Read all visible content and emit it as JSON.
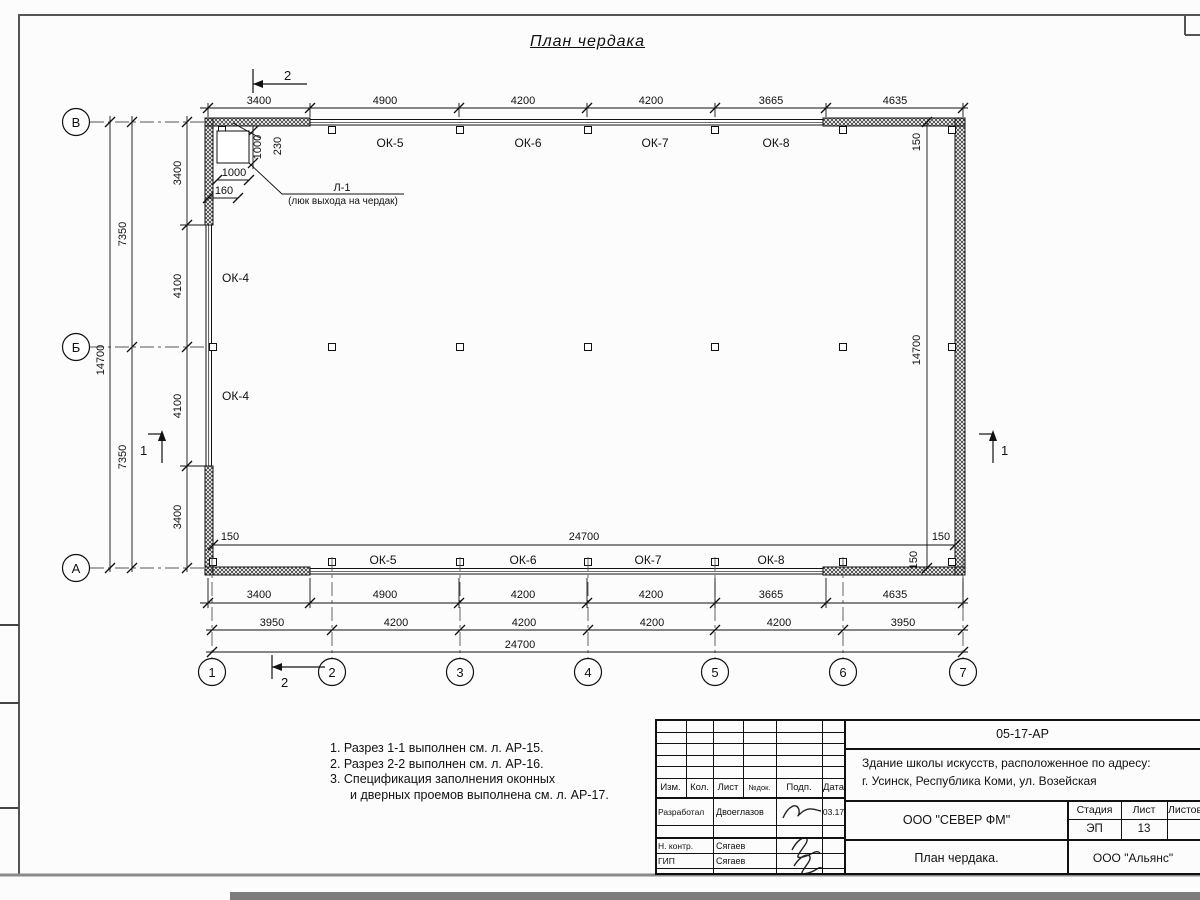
{
  "sheet": {
    "title": "План чердака"
  },
  "plan": {
    "axes_rows": [
      "В",
      "Б",
      "А"
    ],
    "axes_cols": [
      "1",
      "2",
      "3",
      "4",
      "5",
      "6",
      "7"
    ],
    "dims_top": [
      "3400",
      "4900",
      "4200",
      "4200",
      "3665",
      "4635"
    ],
    "dims_row1": [
      "3400",
      "4900",
      "4200",
      "4200",
      "3665",
      "4635"
    ],
    "dims_row2": [
      "3950",
      "4200",
      "4200",
      "4200",
      "4200",
      "3950"
    ],
    "total_width": "24700",
    "total_height": "14700",
    "left_inner": [
      "3400",
      "4100",
      "4100",
      "3400"
    ],
    "left_mid": [
      "7350",
      "7350"
    ],
    "d150": "150",
    "windows_top": [
      "ОК-5",
      "ОК-6",
      "ОК-7",
      "ОК-8"
    ],
    "windows_bottom": [
      "ОК-5",
      "ОК-6",
      "ОК-7",
      "ОК-8"
    ],
    "windows_left": [
      "ОК-4",
      "ОК-4"
    ],
    "hatch": {
      "label": "Л-1",
      "sublabel": "(люк выхода на чердак)",
      "dim_v": "1000",
      "dim_wall": "230",
      "dim_h": "1000",
      "dim_offset": "160"
    },
    "sections": {
      "s1": "1",
      "s2": "2"
    }
  },
  "notes": {
    "lines": [
      "1. Разрез 1-1 выполнен см. л. АР-15.",
      "2. Разрез 2-2 выполнен см. л. АР-16.",
      "3. Спецификация заполнения оконных",
      "и дверных проемов выполнена см. л. АР-17."
    ]
  },
  "tb": {
    "doc_code": "05-17-АР",
    "object_line1": "Здание школы искусств, расположенное по адресу:",
    "object_line2": "г. Усинск, Республика Коми, ул. Возейская",
    "org": "ООО \"СЕВЕР ФМ\"",
    "sheet_title": "План чердака.",
    "contractor": "ООО \"Альянс\"",
    "stage_label": "Стадия",
    "sheet_label": "Лист",
    "sheets_label": "Листов",
    "stage": "ЭП",
    "sheet_no": "13",
    "cols": [
      "Изм.",
      "Кол.",
      "Лист",
      "№док.",
      "Подп.",
      "Дата"
    ],
    "rows": [
      {
        "role": "Разработал",
        "name": "Двоеглазов",
        "date": "03.17"
      },
      {
        "role": "Н. контр.",
        "name": "Сягаев"
      },
      {
        "role": "ГИП",
        "name": "Сягаев"
      }
    ]
  }
}
